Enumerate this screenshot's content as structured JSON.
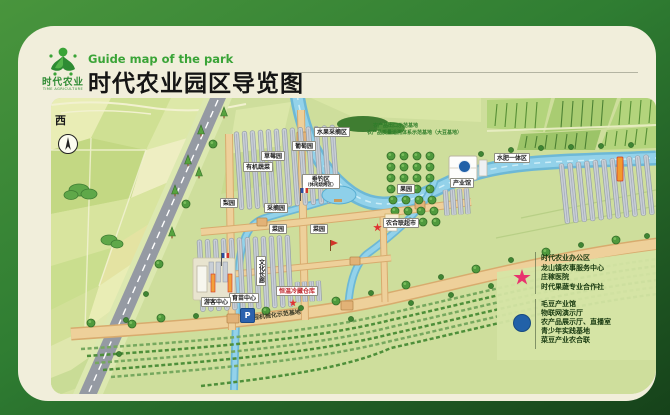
{
  "colors": {
    "frame_green": "#2f7d32",
    "card_cream": "#f1eedb",
    "header_green": "#3aa437",
    "map_base": "#cede9c",
    "river_blue": "#93d2ea",
    "road_tan": "#eed09a",
    "star_pink": "#e8336e",
    "marker_blue": "#2161a8"
  },
  "header": {
    "subtitle_en": "Guide map of the park",
    "title_cn": "时代农业园区导览图",
    "logo": {
      "brand_cn": "时代农业",
      "brand_en": "TIME AGRICULTURE"
    }
  },
  "map": {
    "compass_label": "西",
    "parking_label": "P",
    "labels": [
      {
        "text": "草莓园"
      },
      {
        "text": "葡萄园"
      },
      {
        "text": "水果采摘区"
      },
      {
        "text": "有机蔬菜"
      },
      {
        "text": "垂钓区"
      },
      {
        "text": "（休闲烧烤区）"
      },
      {
        "text": "采摘园"
      },
      {
        "text": "梨园"
      },
      {
        "text": "果园"
      },
      {
        "text": "水肥一体区"
      },
      {
        "text": "产业馆"
      },
      {
        "text": "农合联超市"
      },
      {
        "text": "菜园"
      },
      {
        "text": "菜园"
      },
      {
        "text": "文化长廊"
      },
      {
        "text": "恒温冷藏仓库"
      },
      {
        "text": "育苗中心"
      },
      {
        "text": "游客中心"
      },
      {
        "text": "全程机械化示范基地"
      },
      {
        "text": "农产品出口示范基地"
      },
      {
        "text": "农产品质量追溯体系示范基地（大豆基地）"
      }
    ]
  },
  "legend": {
    "star": {
      "items": [
        "时代农业办公区",
        "龙山镇农事服务中心",
        "庄稼医院",
        "时代果蔬专业合作社"
      ]
    },
    "circle": {
      "items": [
        "毛豆产业馆",
        "物联网演示厅",
        "农产品展示厅、直播室",
        "青少年实践基地",
        "菜豆产业农合联"
      ]
    }
  }
}
